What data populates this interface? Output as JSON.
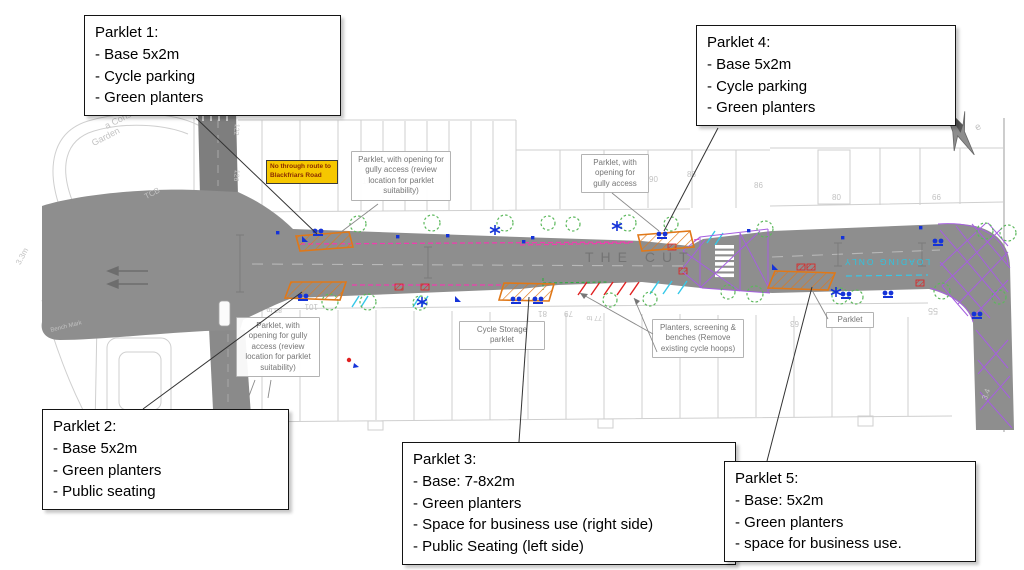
{
  "callouts": [
    {
      "id": "parklet-1",
      "title": "Parklet 1:",
      "lines": [
        "- Base 5x2m",
        "- Cycle parking",
        "- Green planters"
      ]
    },
    {
      "id": "parklet-2",
      "title": "Parklet 2:",
      "lines": [
        "- Base 5x2m",
        "- Green planters",
        "- Public seating"
      ]
    },
    {
      "id": "parklet-3",
      "title": "Parklet 3:",
      "lines": [
        "- Base: 7-8x2m",
        "- Green planters",
        "- Space for business use (right side)",
        "- Public Seating (left side)"
      ]
    },
    {
      "id": "parklet-4",
      "title": "Parklet 4:",
      "lines": [
        "- Base 5x2m",
        "- Cycle parking",
        "- Green planters"
      ]
    },
    {
      "id": "parklet-5",
      "title": "Parklet 5:",
      "lines": [
        "- Base: 5x2m",
        "- Green planters",
        "- space for business use."
      ]
    }
  ],
  "annotations": [
    {
      "id": "gully-top-left",
      "text": "Parklet, with opening for gully access (review location for parklet suitability)"
    },
    {
      "id": "gully-top-right",
      "text": "Parklet, with opening for gully access"
    },
    {
      "id": "gully-bottom-left",
      "text": "Parklet, with opening for gully access (review location for parklet suitability)"
    },
    {
      "id": "cycle-storage",
      "text": "Cycle Storage parklet"
    },
    {
      "id": "planters-screening",
      "text": "Planters, screening & benches (Remove existing cycle hoops)"
    },
    {
      "id": "parklet-plain",
      "text": "Parklet"
    }
  ],
  "warning_label": {
    "text": "No through route to Blackfriars Road",
    "bg": "#f6c700",
    "text_color": "#8a2b00"
  },
  "street": {
    "name": "THE CUT",
    "loading_marking": "LOADING ONLY"
  },
  "map_texts": [
    {
      "t": "a Cons",
      "x": 103,
      "y": 122,
      "r": -27,
      "s": 9
    },
    {
      "t": "Garden",
      "x": 90,
      "y": 139,
      "r": -27,
      "s": 9
    },
    {
      "t": "TCB",
      "x": 143,
      "y": 193,
      "r": -27,
      "s": 8
    },
    {
      "t": "3.3m",
      "x": 14,
      "y": 262,
      "r": -62,
      "s": 8
    },
    {
      "t": "Bench Mark",
      "x": 50,
      "y": 328,
      "r": -14,
      "s": 6
    },
    {
      "t": "122",
      "x": 240,
      "y": 124,
      "r": 96,
      "s": 7
    },
    {
      "t": "126",
      "x": 240,
      "y": 170,
      "r": 96,
      "s": 7
    },
    {
      "t": "110",
      "x": 281,
      "y": 177,
      "r": 0,
      "s": 8
    },
    {
      "t": "108",
      "x": 362,
      "y": 177,
      "r": 0,
      "s": 8
    },
    {
      "t": "90",
      "x": 649,
      "y": 175,
      "r": 0,
      "s": 8
    },
    {
      "t": "88",
      "x": 687,
      "y": 170,
      "r": 0,
      "s": 8
    },
    {
      "t": "86",
      "x": 754,
      "y": 181,
      "r": 0,
      "s": 8
    },
    {
      "t": "80",
      "x": 832,
      "y": 193,
      "r": 0,
      "s": 8
    },
    {
      "t": "66",
      "x": 932,
      "y": 193,
      "r": 0,
      "s": 8
    },
    {
      "t": "83 to",
      "x": 282,
      "y": 313,
      "r": 180,
      "s": 7
    },
    {
      "t": "101",
      "x": 318,
      "y": 311,
      "r": 180,
      "s": 8
    },
    {
      "t": "81",
      "x": 547,
      "y": 318,
      "r": 180,
      "s": 8
    },
    {
      "t": "79",
      "x": 573,
      "y": 318,
      "r": 180,
      "s": 8
    },
    {
      "t": "77 to",
      "x": 602,
      "y": 321,
      "r": 180,
      "s": 7
    },
    {
      "t": "63",
      "x": 799,
      "y": 328,
      "r": 180,
      "s": 8
    },
    {
      "t": "55",
      "x": 938,
      "y": 316,
      "r": 180,
      "s": 9
    },
    {
      "t": "3.4",
      "x": 980,
      "y": 398,
      "r": -70,
      "s": 8
    },
    {
      "t": "e",
      "x": 973,
      "y": 124,
      "r": -30,
      "s": 10
    }
  ],
  "icons": {
    "north-arrow": "compass-star",
    "tree": "dashed-green-circle",
    "cycle-stand": "blue-dot-pair",
    "cycle-symbol": "blue-asterisk",
    "zebra-crossing": "white-bars",
    "parklet": "orange-hatched-outline"
  },
  "colors": {
    "road": "#8e8e8e",
    "parklet_orange": "#e07818",
    "tree_green": "#5cb85c",
    "cycle_blue": "#1533d8",
    "restriction_magenta": "#ee3fae",
    "crossing_purple": "#a65fe0",
    "loading_cyan": "#2ec4e0",
    "marking_red": "#e02020",
    "warning_yellow": "#f6c700",
    "basemap_gray": "#cfcfcf"
  }
}
